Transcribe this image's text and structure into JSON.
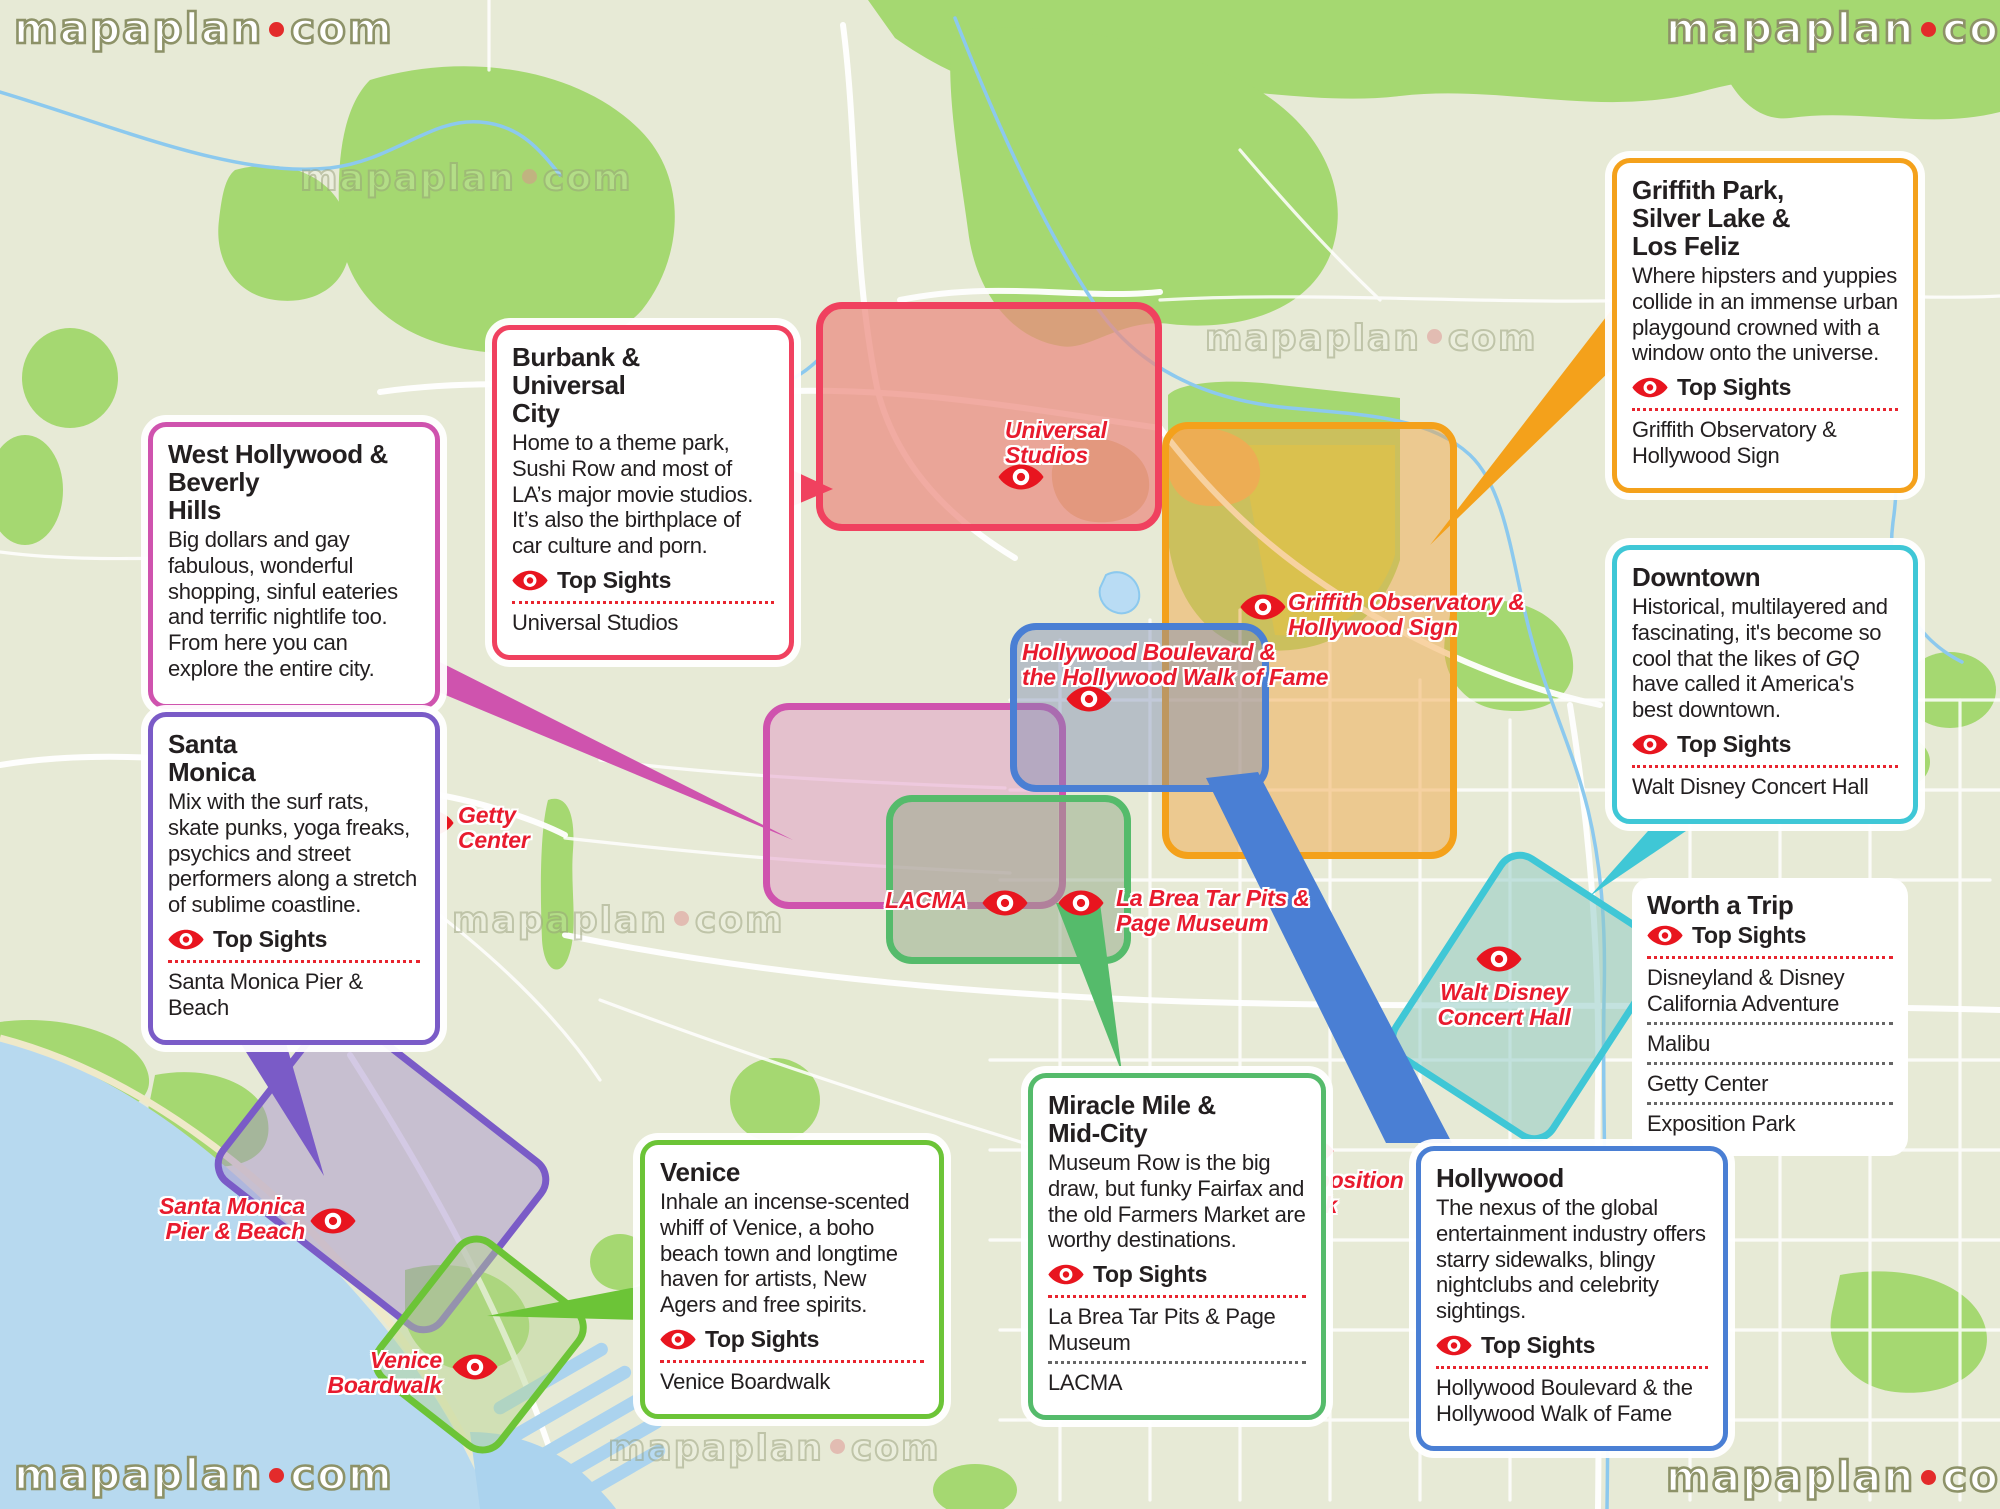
{
  "brand": {
    "name": "mapaplan",
    "tld": "com"
  },
  "labels": {
    "top_sights": "Top Sights"
  },
  "colors": {
    "label_red": "#e81b2e",
    "marker_red": "#e8151f",
    "burbank": "#f0415f",
    "griffith": "#f4a11b",
    "hollywood": "#4a7fd4",
    "west_hollywood": "#cf53ae",
    "miracle_mile": "#55bb6b",
    "santa_monica": "#7a5bc7",
    "venice": "#6cc437",
    "downtown": "#3fc7d6",
    "ocean": "#b7d9ef",
    "park_green": "#a5d871",
    "map_base": "#e7ead6"
  },
  "callouts": {
    "west_hollywood": {
      "title": "West Hollywood &\nBeverly\nHills",
      "body": "Big dollars and gay fabulous, wonderful shopping, sinful eateries and terrific nightlife too. From here you can explore the entire city."
    },
    "santa_monica": {
      "title": "Santa\nMonica",
      "body": "Mix with the surf rats, skate punks, yoga freaks, psychics and street performers along a stretch of sublime coastline.",
      "sights": [
        "Santa Monica Pier & Beach"
      ]
    },
    "burbank": {
      "title": "Burbank &\nUniversal\nCity",
      "body": "Home to a theme park, Sushi Row and most of LA’s major movie studios. It’s also the birthplace of car culture and porn.",
      "sights": [
        "Universal Studios"
      ]
    },
    "griffith": {
      "title": "Griffith Park,\nSilver Lake &\nLos Feliz",
      "body": "Where hipsters and yuppies collide in an immense urban playgound crowned with a window onto the universe.",
      "sights": [
        "Griffith Observatory & Hollywood Sign"
      ]
    },
    "downtown": {
      "title": "Downtown",
      "body_pre": "Historical, multilayered and fascinating, it's become so cool that the likes of ",
      "body_italic": "GQ",
      "body_post": " have called it America's best downtown.",
      "sights": [
        "Walt Disney Concert Hall"
      ]
    },
    "worth_a_trip": {
      "title": "Worth a Trip",
      "sights": [
        "Disneyland & Disney California Adventure",
        "Malibu",
        "Getty Center",
        "Exposition Park"
      ]
    },
    "hollywood": {
      "title": "Hollywood",
      "body": "The nexus of the global entertainment industry offers starry sidewalks, blingy nightclubs and celebrity sightings.",
      "sights": [
        "Hollywood Boulevard & the Hollywood Walk of Fame"
      ]
    },
    "miracle_mile": {
      "title": "Miracle Mile &\nMid-City",
      "body": "Museum Row is the big draw, but funky Fairfax and the old Farmers Market are worthy destinations.",
      "sights": [
        "La Brea Tar Pits & Page Museum",
        "LACMA"
      ]
    },
    "venice": {
      "title": "Venice",
      "body": "Inhale an incense-scented whiff of Venice, a boho beach town and longtime haven for artists, New Agers and free spirits.",
      "sights": [
        "Venice Boardwalk"
      ]
    }
  },
  "map_labels": {
    "universal": "Universal\nStudios",
    "griffith_observatory": "Griffith Observatory &\nHollywood Sign",
    "hollywood_blvd": "Hollywood Boulevard &\nthe Hollywood Walk of Fame",
    "getty": "Getty\nCenter",
    "lacma": "LACMA",
    "la_brea": "La Brea Tar Pits &\nPage Museum",
    "disney_hall": "Walt Disney\nConcert Hall",
    "exposition": "Exposition\nPark",
    "sm_pier": "Santa Monica\nPier & Beach",
    "venice_boardwalk": "Venice\nBoardwalk"
  }
}
